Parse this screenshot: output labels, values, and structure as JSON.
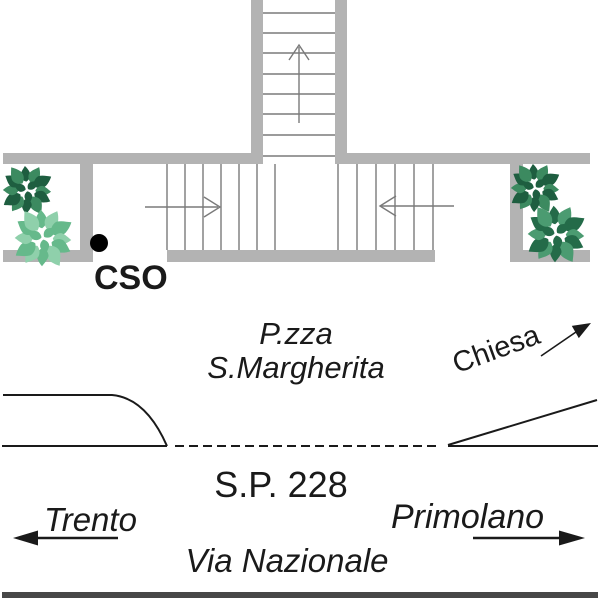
{
  "labels": {
    "marker_cso": "CSO",
    "piazza_line1": "P.zza",
    "piazza_line2": "S.Margherita",
    "chiesa": "Chiesa",
    "provincial_road": "S.P. 228",
    "street": "Via Nazionale",
    "destination_west": "Trento",
    "destination_east": "Primolano"
  },
  "colors": {
    "wall": "#b3b3b3",
    "stair-line": "#7a7a7a",
    "ink": "#1a1a1a",
    "bar": "#474747",
    "marker": "#000000"
  },
  "trees": [
    {
      "cx": 27,
      "cy": 190,
      "scale": 0.92,
      "colors": [
        "#1e5e40",
        "#3c8a60"
      ]
    },
    {
      "cx": 43,
      "cy": 238,
      "scale": 1.08,
      "colors": [
        "#66b98b",
        "#8fd0ab"
      ]
    },
    {
      "cx": 535,
      "cy": 188,
      "scale": 0.92,
      "colors": [
        "#1e5e40",
        "#3c8a60"
      ]
    },
    {
      "cx": 556,
      "cy": 234,
      "scale": 1.08,
      "colors": [
        "#246b49",
        "#4b9b71"
      ]
    }
  ]
}
